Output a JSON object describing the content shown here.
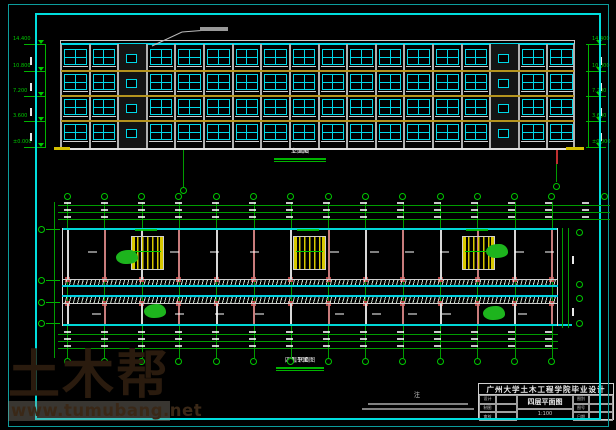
{
  "colors": {
    "cad_green": "#00b400",
    "grid_green": "#009c00",
    "cad_cyan": "#00d8d8",
    "window_cyan": "#00d8e8",
    "band_yellow": "#b5941e",
    "stair_yellow": "#d8c800",
    "column_red": "#b84444",
    "plant_green": "#1db41d",
    "ground_white": "#e0e0e0",
    "frame_inner_cyan": "#00dede",
    "frame_outer_cyan": "#0c9c9c"
  },
  "elevation": {
    "caption": "立面图",
    "scale": "1:100",
    "floors": 4,
    "bays": 18,
    "stair_bays": [
      2,
      15
    ],
    "levels": [
      "14.400",
      "10.800",
      "7.200",
      "3.600",
      "±0.000"
    ]
  },
  "plan": {
    "caption": "四层平面图",
    "scale": "1:100",
    "grid_count": 14,
    "note_marker": "注"
  },
  "title_block": {
    "school": "广州大学土木工程学院毕业设计",
    "drawing": "四层平面图",
    "scale": "1:100",
    "left_fields": [
      "设计",
      "制图",
      "审核"
    ],
    "right_fields": [
      "图别",
      "图号",
      "日期"
    ]
  },
  "watermark": {
    "brand": "土木帮",
    "url": "www.tumubang.net"
  }
}
